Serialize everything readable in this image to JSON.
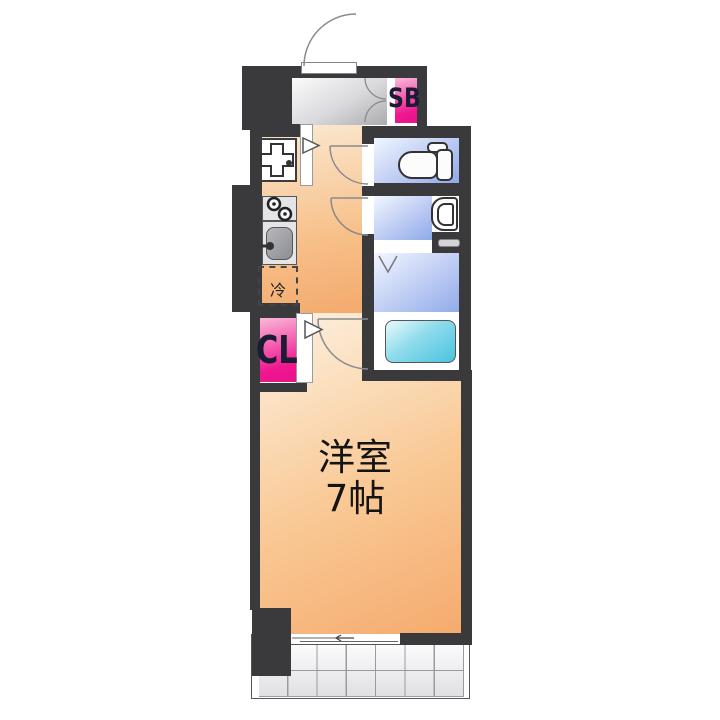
{
  "title": "apartment-floor-plan",
  "labels": {
    "shoe_box": "SB",
    "closet": "CL",
    "room_name": "洋室",
    "room_size": "7帖",
    "refrigerator": "冷"
  },
  "rooms": [
    {
      "name": "entrance-hall",
      "color": "gray"
    },
    {
      "name": "kitchen-corridor",
      "color": "peach"
    },
    {
      "name": "toilet-room",
      "color": "blue"
    },
    {
      "name": "washbasin-room",
      "color": "blue"
    },
    {
      "name": "bathroom",
      "color": "blue"
    },
    {
      "name": "western-room",
      "label": "洋室 7帖",
      "color": "peach"
    },
    {
      "name": "balcony",
      "color": "white-grid"
    }
  ],
  "fixtures": [
    "entrance-door",
    "shoe-box",
    "shoe-box-doors",
    "washing-machine-pan",
    "stove",
    "kitchen-sink",
    "refrigerator-space",
    "closet",
    "toilet",
    "washbasin",
    "bathtub",
    "folding-door",
    "hinged-doors",
    "sliding-window"
  ],
  "colors": {
    "wall": "#3a3a3c",
    "room_peach": "#f5aa6d",
    "wet_area_blue": "#8fa9e9",
    "accent_pink": "#e8138a",
    "bathtub_cyan": "#49c3de",
    "entrance_gray": "#ababaf"
  }
}
